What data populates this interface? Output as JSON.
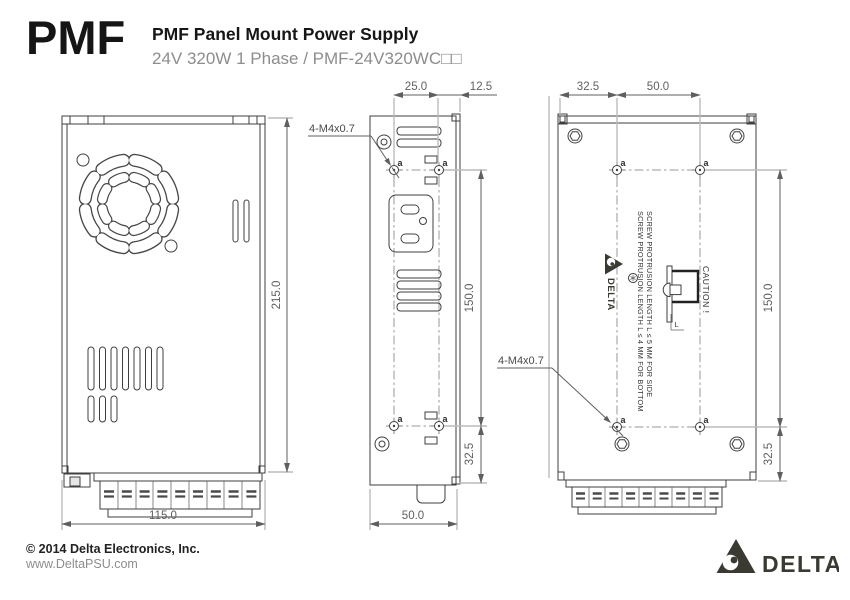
{
  "header": {
    "product_code": "PMF",
    "title": "PMF Panel Mount Power Supply",
    "subtitle": "24V 320W 1 Phase / PMF-24V320WC□□"
  },
  "footer": {
    "copyright": "© 2014 Delta Electronics, Inc.",
    "website": "www.DeltaPSU.com",
    "brand": "DELTA"
  },
  "drawing": {
    "front_view": {
      "dim_height": "215.0",
      "dim_width": "115.0"
    },
    "side_view": {
      "dim_hole_inset_top": "25.0",
      "dim_front_offset": "12.5",
      "dim_hole_span": "150.0",
      "dim_hole_inset_bottom": "32.5",
      "dim_depth": "50.0",
      "screw_label": "4-M4x0.7",
      "hole_label": "a"
    },
    "bottom_view": {
      "dim_side_offset": "32.5",
      "dim_hole_pitch": "50.0",
      "dim_hole_span": "150.0",
      "dim_hole_inset_bottom": "32.5",
      "screw_label": "4-M4x0.7",
      "hole_label": "a",
      "caution": "CAUTION !",
      "note_line1": "SCREW PROTRUSION LENGTH L ≤ 4 MM FOR BOTTOM",
      "note_line2": "SCREW PROTRUSION LENGTH L ≤ 5 MM FOR SIDE",
      "length_label": "L",
      "brand": "DELTA"
    }
  },
  "colors": {
    "outline": "#3f3f3f",
    "dimension": "#5f5f5f",
    "extension": "#bcbcbc",
    "centerline": "#9a9a9a",
    "subtitle_gray": "#8d8d8d",
    "brand_dark": "#3a3a33"
  }
}
